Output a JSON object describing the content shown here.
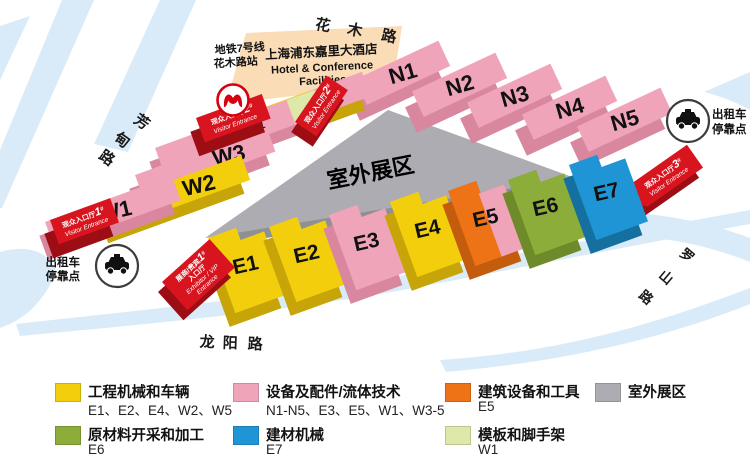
{
  "colors": {
    "yellow": "#F2CE0C",
    "pink": "#F0A4BA",
    "red": "#D8141E",
    "orange": "#EE7216",
    "olive": "#8CAD3A",
    "blue": "#2095D5",
    "light_green": "#DDE8A9",
    "gray": "#ACACB2",
    "hotel_peach": "#FADCB6",
    "road_blue": "#D9EBF8"
  },
  "roads": {
    "top": [
      "花",
      "木",
      "路"
    ],
    "left": [
      "芳",
      "甸",
      "路"
    ],
    "bottom": [
      "龙",
      "阳",
      "路"
    ],
    "right": [
      "罗",
      "山",
      "路"
    ]
  },
  "metro": {
    "line1": "地铁7号线",
    "line2": "花木路站"
  },
  "hotel": {
    "cn": "上海浦东嘉里大酒店",
    "en1": "Hotel & Conference",
    "en2": "Facilities"
  },
  "outdoor_area": "室外展区",
  "taxi": {
    "line1": "出租车",
    "line2": "停靠点"
  },
  "halls": {
    "w": [
      "W1",
      "W2",
      "W3",
      "W4",
      "W5"
    ],
    "n": [
      "N1",
      "N2",
      "N3",
      "N4",
      "N5"
    ],
    "e": [
      "E1",
      "E2",
      "E3",
      "E4",
      "E5",
      "E6",
      "E7"
    ]
  },
  "entrances": {
    "hash": "#",
    "v1": {
      "cn": "观众入口厅",
      "num": "1",
      "en": "Visitor Entrance"
    },
    "v2": {
      "cn": "观众入口厅",
      "num": "2",
      "en": "Visitor Entrance"
    },
    "v3": {
      "cn": "观众入口厅",
      "num": "3",
      "en": "Visitor Entrance"
    },
    "vip": {
      "cn1": "展商/贵宾",
      "num": "1",
      "cn2": "入口厅",
      "en1": "Exhibitor / VIP",
      "en2": "Entrance"
    }
  },
  "legend": {
    "items": [
      {
        "color": "#F2CE0C",
        "title": "工程机械和车辆",
        "halls": "E1、E2、E4、W2、W5"
      },
      {
        "color": "#F0A4BA",
        "title": "设备及配件/流体技术",
        "halls": "N1-N5、E3、E5、W1、W3-5"
      },
      {
        "color": "#EE7216",
        "title": "建筑设备和工具",
        "halls": "E5"
      },
      {
        "color": "#ACACB2",
        "title": "室外展区",
        "halls": ""
      },
      {
        "color": "#8CAD3A",
        "title": "原材料开采和加工",
        "halls": "E6"
      },
      {
        "color": "#2095D5",
        "title": "建材机械",
        "halls": "E7"
      },
      {
        "color": "#DDE8A9",
        "title": "模板和脚手架",
        "halls": "W1"
      }
    ]
  }
}
